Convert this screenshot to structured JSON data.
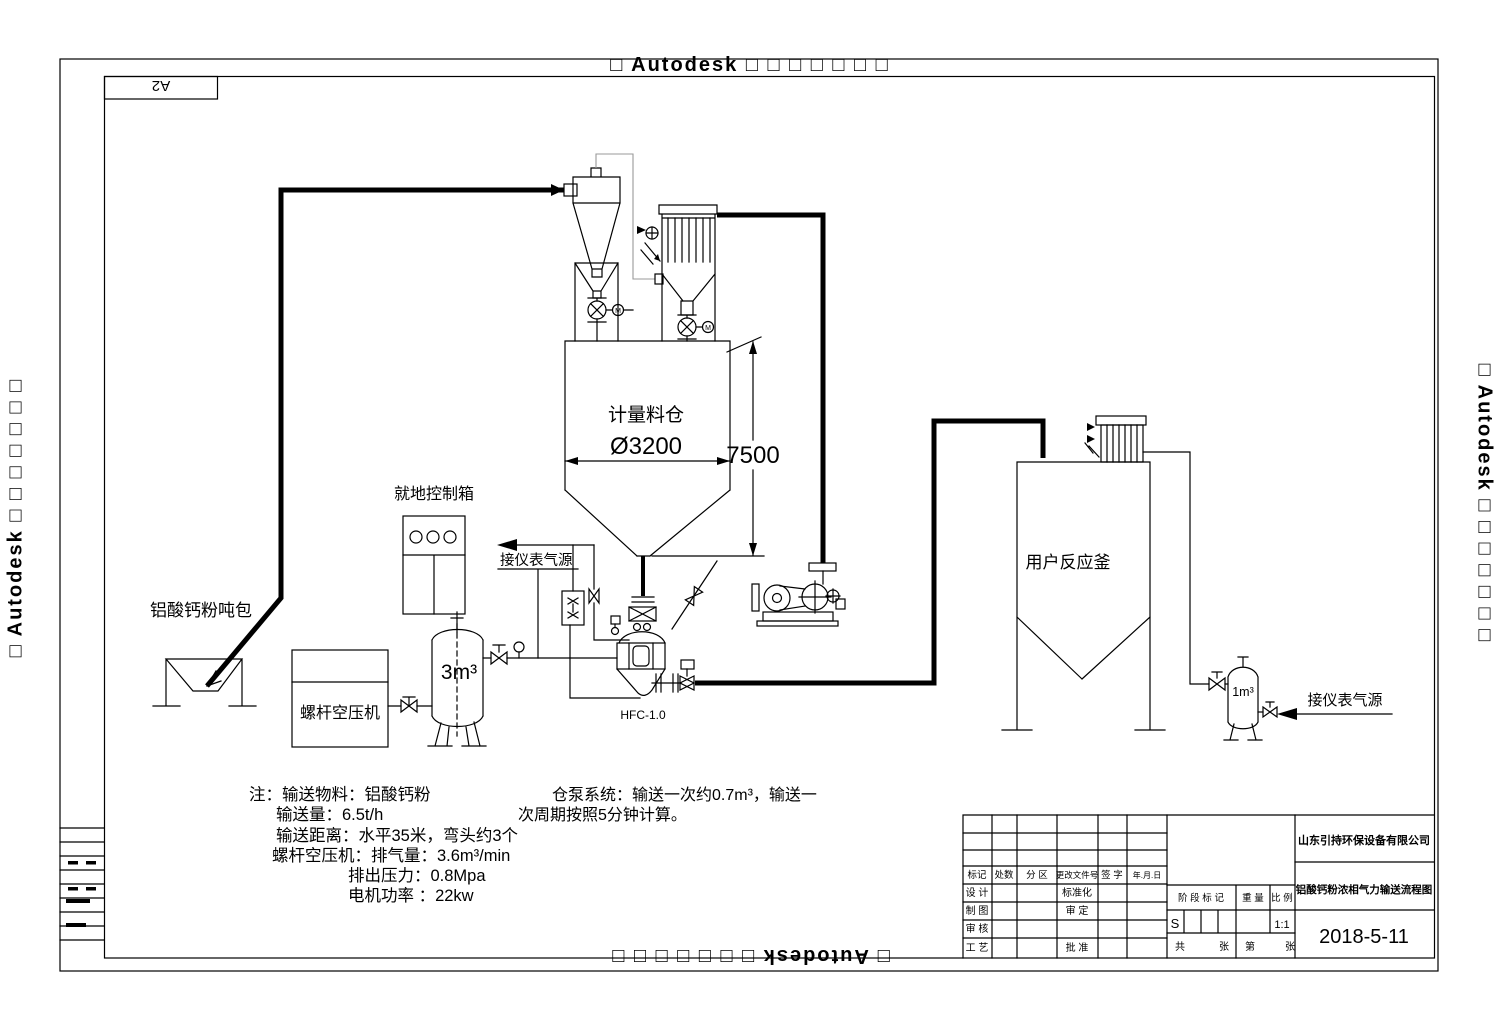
{
  "watermarks": {
    "text": "□ Autodesk □ □ □ □ □ □ □"
  },
  "frame": {
    "size_label": "A2"
  },
  "labels": {
    "ton_bag": "铝酸钙粉吨包",
    "control_box": "就地控制箱",
    "compressor": "螺杆空压机",
    "air_tank_volume": "3m³",
    "silo": "计量料仓",
    "silo_diameter": "Ø3200",
    "silo_height": "7500",
    "pump_model": "HFC-1.0",
    "reactor": "用户反应釜",
    "buffer_tank_volume": "1m³",
    "instrument_air": "接仪表气源",
    "motor": "M"
  },
  "notes": {
    "line1": "注：输送物料：铝酸钙粉",
    "line2": "输送量：6.5t/h",
    "line3": "输送距离：水平35米，弯头约3个",
    "line4": "螺杆空压机：排气量：3.6m³/min",
    "line5": "排出压力：0.8Mpa",
    "line6": "电机功率 ：22kw"
  },
  "pump_note": {
    "line1": "仓泵系统：输送一次约0.7m³，输送一",
    "line2": "次周期按照5分钟计算。"
  },
  "title_block": {
    "company": "山东引持环保设备有限公司",
    "drawing_title": "铝酸钙粉浓相气力输送流程图",
    "date": "2018-5-11",
    "stage_mark": "S",
    "scale": "1:1",
    "col_headers": {
      "mark": "标记",
      "count": "处数",
      "zone": "分 区",
      "change_doc": "更改文件号",
      "signature": "签 字",
      "date": "年.月.日"
    },
    "row_labels": {
      "design": "设 计",
      "draft": "制 图",
      "check": "审 核",
      "process": "工 艺",
      "standardize": "标准化",
      "approve_check": "审 定",
      "approve": "批 准"
    },
    "mid_headers": {
      "stage": "阶 段 标 记",
      "weight": "重 量",
      "scale": "比 例"
    },
    "sheet": {
      "total_label": "共",
      "sheet_label": "张",
      "page_label": "第",
      "page_label2": "张"
    }
  }
}
